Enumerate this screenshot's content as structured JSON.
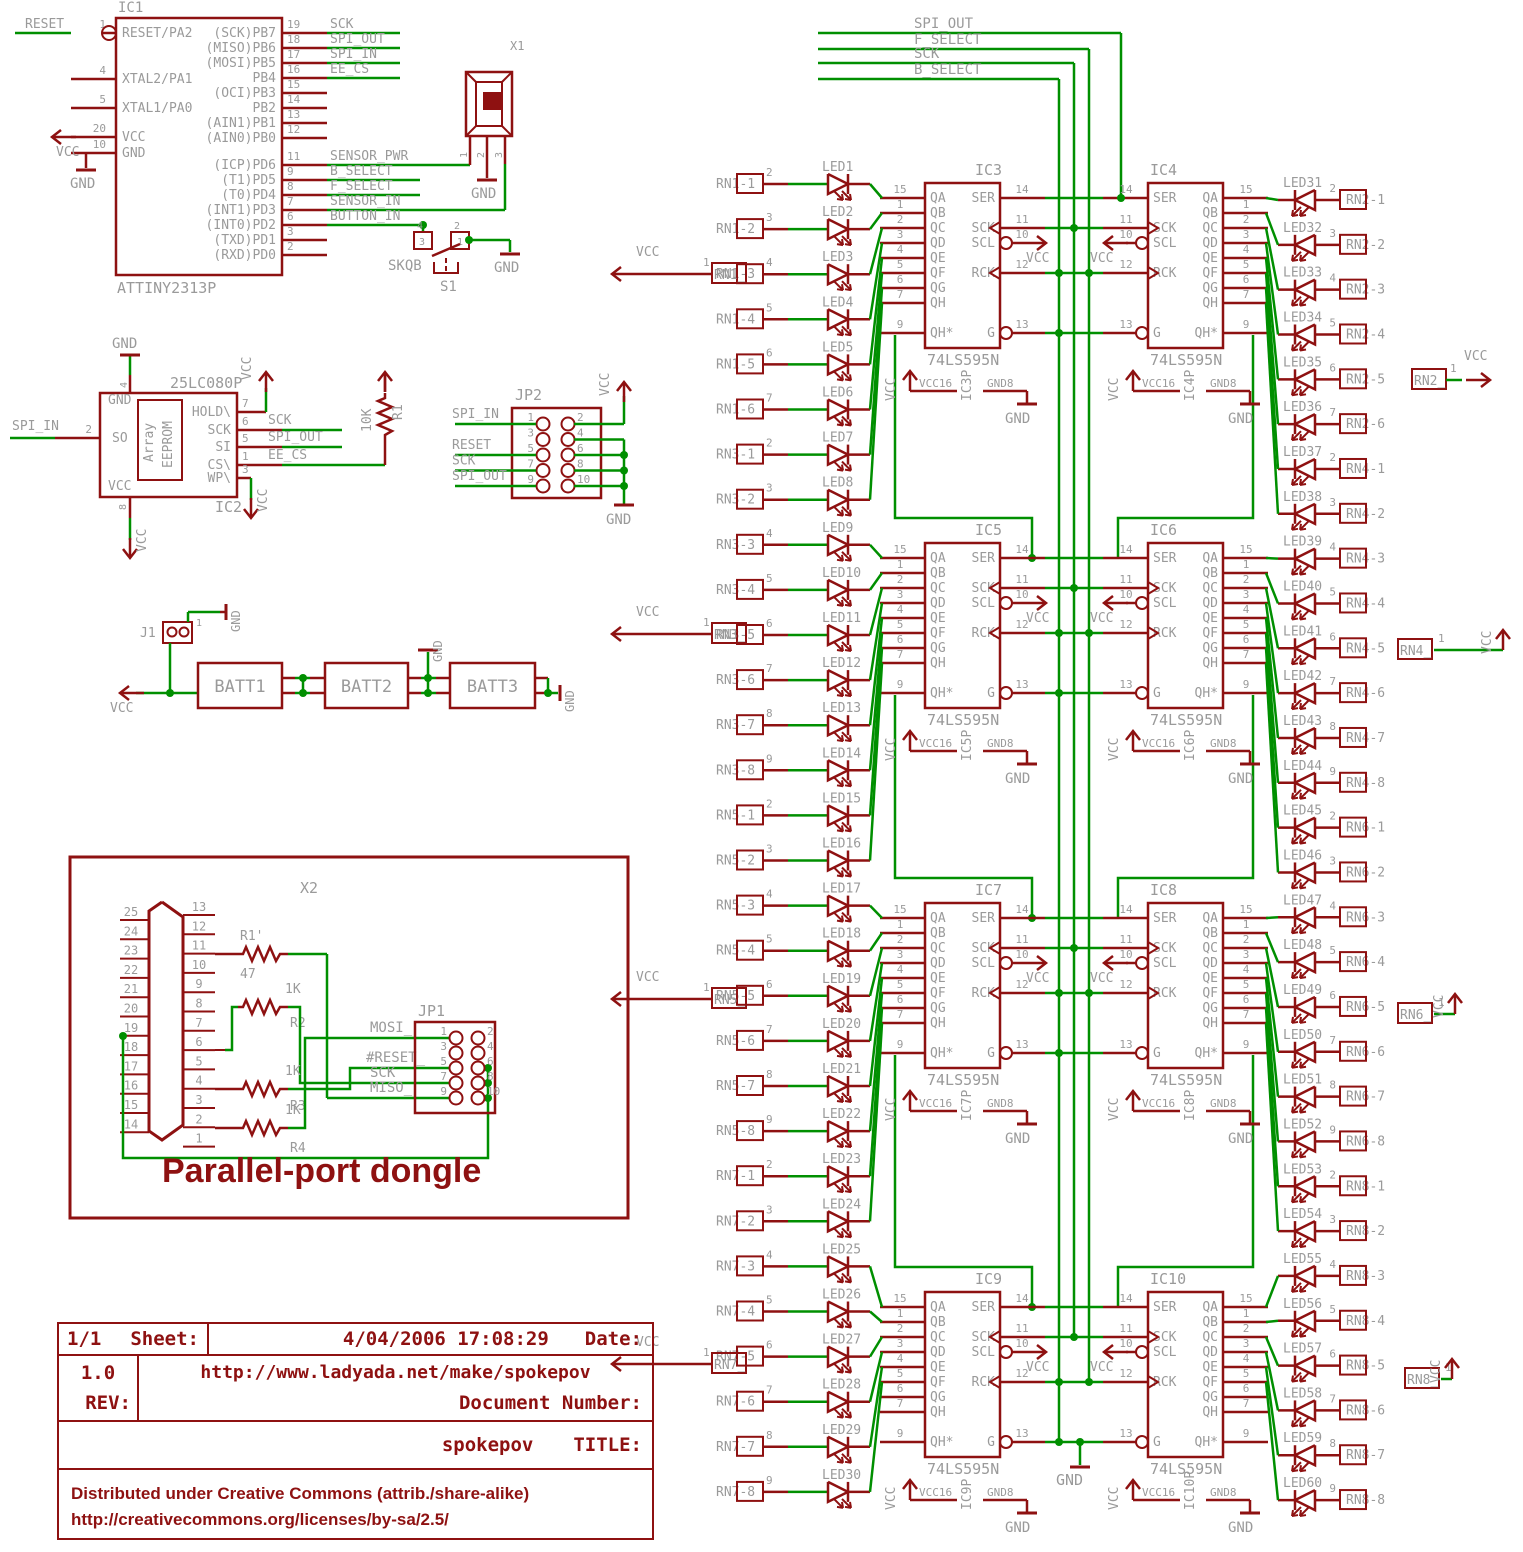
{
  "colors": {
    "symbol": "#8E1111",
    "wire": "#008F00",
    "text_gray": "#9A9A9A",
    "background": "#FFFFFF"
  },
  "nets": {
    "vcc": "VCC",
    "gnd": "GND"
  },
  "bus": [
    "SPI_OUT",
    "F_SELECT",
    "SCK",
    "B_SELECT"
  ],
  "mcu": {
    "designator": "IC1",
    "part": "ATTINY2313P",
    "reset_net": "RESET",
    "left_pins": [
      [
        "1",
        "RESET/PA2"
      ],
      [
        "4",
        "XTAL2/PA1"
      ],
      [
        "5",
        "XTAL1/PA0"
      ],
      [
        "20",
        "VCC"
      ],
      [
        "10",
        "GND"
      ]
    ],
    "right_pins": [
      [
        "19",
        "(SCK)PB7",
        "SCK"
      ],
      [
        "18",
        "(MISO)PB6",
        "SPI_OUT"
      ],
      [
        "17",
        "(MOSI)PB5",
        "SPI_IN"
      ],
      [
        "16",
        "PB4",
        "EE_CS"
      ],
      [
        "15",
        "(OCI)PB3",
        ""
      ],
      [
        "14",
        "PB2",
        ""
      ],
      [
        "13",
        "(AIN1)PB1",
        ""
      ],
      [
        "12",
        "(AIN0)PB0",
        ""
      ],
      [
        "11",
        "(ICP)PD6",
        "SENSOR_PWR"
      ],
      [
        "9",
        "(T1)PD5",
        "B_SELECT"
      ],
      [
        "8",
        "(T0)PD4",
        "F_SELECT"
      ],
      [
        "7",
        "(INT1)PD3",
        "SENSOR_IN"
      ],
      [
        "6",
        "(INT0)PD2",
        "BUTTON_IN"
      ],
      [
        "3",
        "(TXD)PD1",
        ""
      ],
      [
        "2",
        "(RXD)PD0",
        ""
      ]
    ]
  },
  "sensor": {
    "designator": "X1",
    "pins": [
      "1",
      "2",
      "3"
    ]
  },
  "button": {
    "designator": "S1",
    "part": "SKQB",
    "contacts": [
      "4",
      "3",
      "2",
      "1"
    ]
  },
  "eeprom": {
    "designator": "IC2",
    "part": "25LC080P",
    "inner1": "Array",
    "inner2": "EEPROM",
    "gnd_pin": "4",
    "so_pin": "2",
    "so_name": "SO",
    "so_net": "SPI_IN",
    "vcc_pin": "8",
    "gnd_name": "GND",
    "vcc_name": "VCC",
    "right_pins": [
      [
        "7",
        "HOLD\\",
        ""
      ],
      [
        "6",
        "SCK",
        "SCK"
      ],
      [
        "5",
        "SI",
        "SPI_OUT"
      ],
      [
        "1",
        "CS\\",
        "EE_CS"
      ],
      [
        "3",
        "WP\\",
        ""
      ]
    ]
  },
  "r1": {
    "designator": "R1",
    "value": "10K"
  },
  "jp2": {
    "designator": "JP2",
    "rows": [
      [
        "1",
        "2"
      ],
      [
        "3",
        "4"
      ],
      [
        "5",
        "6"
      ],
      [
        "7",
        "8"
      ],
      [
        "9",
        "10"
      ]
    ],
    "left_nets": [
      "SPI_IN",
      "",
      "RESET",
      "SCK",
      "SPI_OUT"
    ]
  },
  "battery": {
    "j1": "J1",
    "j1_pin": "1",
    "cells": [
      "BATT1",
      "BATT2",
      "BATT3"
    ]
  },
  "dongle": {
    "title": "Parallel-port dongle",
    "connector": {
      "designator": "X2",
      "left_pins": [
        "25",
        "24",
        "23",
        "22",
        "21",
        "20",
        "19",
        "18",
        "17",
        "16",
        "15",
        "14"
      ],
      "right_pins": [
        "13",
        "12",
        "11",
        "10",
        "9",
        "8",
        "7",
        "6",
        "5",
        "4",
        "3",
        "2",
        "1"
      ]
    },
    "resistors": [
      [
        "R1'",
        "47"
      ],
      [
        "R2",
        "1K"
      ],
      [
        "R3",
        "1K"
      ],
      [
        "R4",
        "1K"
      ]
    ],
    "jp1": {
      "designator": "JP1",
      "rows": [
        [
          "1",
          "2"
        ],
        [
          "3",
          "4"
        ],
        [
          "5",
          "6"
        ],
        [
          "7",
          "8"
        ],
        [
          "9",
          "10"
        ]
      ]
    },
    "signals": [
      "MOSI_",
      "#RESET_",
      "SCK",
      "MISO_"
    ]
  },
  "ics": {
    "part": "74LS595N",
    "rows": [
      {
        "left": "IC3",
        "right": "IC4"
      },
      {
        "left": "IC5",
        "right": "IC6"
      },
      {
        "left": "IC7",
        "right": "IC8"
      },
      {
        "left": "IC9",
        "right": "IC10"
      }
    ],
    "outputs": [
      [
        "QA",
        "15"
      ],
      [
        "QB",
        "1"
      ],
      [
        "QC",
        "2"
      ],
      [
        "QD",
        "3"
      ],
      [
        "QE",
        "4"
      ],
      [
        "QF",
        "5"
      ],
      [
        "QG",
        "6"
      ],
      [
        "QH",
        "7"
      ],
      [
        "QH*",
        "9"
      ]
    ],
    "controls": [
      [
        "SER",
        "14"
      ],
      [
        "SCK",
        "11"
      ],
      [
        "SCL",
        "10"
      ],
      [
        "RCK",
        "12"
      ],
      [
        "G",
        "13"
      ]
    ],
    "power": {
      "vcc": "VCC",
      "vcc_pin": "16",
      "gnd": "GND",
      "gnd_pin": "8",
      "suffix": "P"
    }
  },
  "led_left": [
    {
      "common": "RN1_",
      "common_pin": "1",
      "items": [
        [
          "LED1",
          "RN1-1",
          "2"
        ],
        [
          "LED2",
          "RN1-2",
          "3"
        ],
        [
          "LED3",
          "RN1-3",
          "4"
        ],
        [
          "LED4",
          "RN1-4",
          "5"
        ],
        [
          "LED5",
          "RN1-5",
          "6"
        ],
        [
          "LED6",
          "RN1-6",
          "7"
        ]
      ]
    },
    {
      "common": "RN3_",
      "common_pin": "1",
      "items": [
        [
          "LED7",
          "RN3-1",
          "2"
        ],
        [
          "LED8",
          "RN3-2",
          "3"
        ],
        [
          "LED9",
          "RN3-3",
          "4"
        ],
        [
          "LED10",
          "RN3-4",
          "5"
        ],
        [
          "LED11",
          "RN3-5",
          "6"
        ],
        [
          "LED12",
          "RN3-6",
          "7"
        ],
        [
          "LED13",
          "RN3-7",
          "8"
        ],
        [
          "LED14",
          "RN3-8",
          "9"
        ]
      ]
    },
    {
      "common": "RN5_",
      "common_pin": "1",
      "items": [
        [
          "LED15",
          "RN5-1",
          "2"
        ],
        [
          "LED16",
          "RN5-2",
          "3"
        ],
        [
          "LED17",
          "RN5-3",
          "4"
        ],
        [
          "LED18",
          "RN5-4",
          "5"
        ],
        [
          "LED19",
          "RN5-5",
          "6"
        ],
        [
          "LED20",
          "RN5-6",
          "7"
        ],
        [
          "LED21",
          "RN5-7",
          "8"
        ],
        [
          "LED22",
          "RN5-8",
          "9"
        ]
      ]
    },
    {
      "common": "RN7_",
      "common_pin": "1",
      "items": [
        [
          "LED23",
          "RN7-1",
          "2"
        ],
        [
          "LED24",
          "RN7-2",
          "3"
        ],
        [
          "LED25",
          "RN7-3",
          "4"
        ],
        [
          "LED26",
          "RN7-4",
          "5"
        ],
        [
          "LED27",
          "RN7-5",
          "6"
        ],
        [
          "LED28",
          "RN7-6",
          "7"
        ],
        [
          "LED29",
          "RN7-7",
          "8"
        ],
        [
          "LED30",
          "RN7-8",
          "9"
        ]
      ]
    }
  ],
  "led_right": [
    {
      "common": "RN2_",
      "common_pin": "1",
      "items": [
        [
          "LED31",
          "RN2-1",
          "2"
        ],
        [
          "LED32",
          "RN2-2",
          "3"
        ],
        [
          "LED33",
          "RN2-3",
          "4"
        ],
        [
          "LED34",
          "RN2-4",
          "5"
        ],
        [
          "LED35",
          "RN2-5",
          "6"
        ],
        [
          "LED36",
          "RN2-6",
          "7"
        ]
      ]
    },
    {
      "common": "RN4_",
      "common_pin": "1",
      "items": [
        [
          "LED37",
          "RN4-1",
          "2"
        ],
        [
          "LED38",
          "RN4-2",
          "3"
        ],
        [
          "LED39",
          "RN4-3",
          "4"
        ],
        [
          "LED40",
          "RN4-4",
          "5"
        ],
        [
          "LED41",
          "RN4-5",
          "6"
        ],
        [
          "LED42",
          "RN4-6",
          "7"
        ],
        [
          "LED43",
          "RN4-7",
          "8"
        ],
        [
          "LED44",
          "RN4-8",
          "9"
        ]
      ]
    },
    {
      "common": "RN6_",
      "common_pin": "1",
      "items": [
        [
          "LED45",
          "RN6-1",
          "2"
        ],
        [
          "LED46",
          "RN6-2",
          "3"
        ],
        [
          "LED47",
          "RN6-3",
          "4"
        ],
        [
          "LED48",
          "RN6-4",
          "5"
        ],
        [
          "LED49",
          "RN6-5",
          "6"
        ],
        [
          "LED50",
          "RN6-6",
          "7"
        ],
        [
          "LED51",
          "RN6-7",
          "8"
        ],
        [
          "LED52",
          "RN6-8",
          "9"
        ]
      ]
    },
    {
      "common": "RN8_",
      "common_pin": "1",
      "items": [
        [
          "LED53",
          "RN8-1",
          "2"
        ],
        [
          "LED54",
          "RN8-2",
          "3"
        ],
        [
          "LED55",
          "RN8-3",
          "4"
        ],
        [
          "LED56",
          "RN8-4",
          "5"
        ],
        [
          "LED57",
          "RN8-5",
          "6"
        ],
        [
          "LED58",
          "RN8-6",
          "7"
        ],
        [
          "LED59",
          "RN8-7",
          "8"
        ],
        [
          "LED60",
          "RN8-8",
          "9"
        ]
      ]
    }
  ],
  "titleblock": {
    "sheet_value": "1/1",
    "sheet_label": "Sheet:",
    "date_value": "4/04/2006 17:08:29",
    "date_label": "Date:",
    "rev_value": "1.0",
    "rev_label": "REV:",
    "url": "http://www.ladyada.net/make/spokepov",
    "docnum_label": "Document Number:",
    "title_value": "spokepov",
    "title_label": "TITLE:",
    "license1": "Distributed under Creative Commons (attrib./share-alike)",
    "license2": "http://creativecommons.org/licenses/by-sa/2.5/"
  }
}
